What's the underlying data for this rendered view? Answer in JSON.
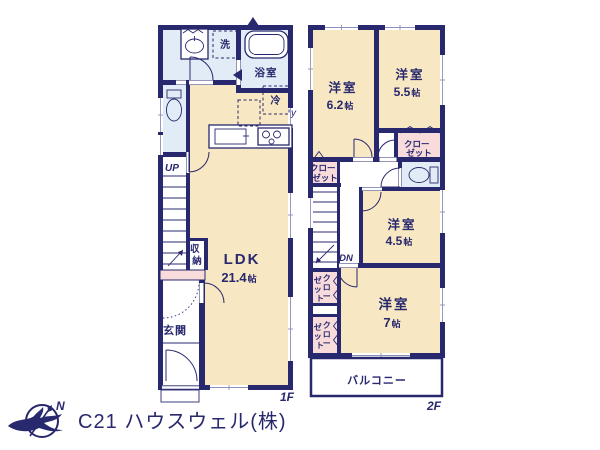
{
  "title": "間取り図",
  "colors": {
    "wall": "#28286e",
    "room": "#f7e7c3",
    "sanitary": "#e2ecf6",
    "closet": "#f8dcdc",
    "text": "#28286e",
    "logo_text": "#c8c8c8",
    "background": "#ffffff"
  },
  "floor1": {
    "floor_label": "1F",
    "ldk": {
      "name": "LDK",
      "size_num": "21.4",
      "size_unit": "帖"
    },
    "entrance_label": "玄関",
    "bath_label": "浴室",
    "laundry_label": "洗",
    "fridge_label": "冷",
    "storage_label": {
      "char1": "収",
      "char2": "納"
    },
    "stairs_label": "UP",
    "wall_annotation": "y"
  },
  "floor2": {
    "floor_label": "2F",
    "room_6_2": {
      "name": "洋室",
      "size_num": "6.2",
      "size_unit": "帖"
    },
    "room_5_5": {
      "name": "洋室",
      "size_num": "5.5",
      "size_unit": "帖"
    },
    "room_4_5": {
      "name": "洋室",
      "size_num": "4.5",
      "size_unit": "帖"
    },
    "room_7": {
      "name": "洋室",
      "size_num": "7",
      "size_unit": "帖"
    },
    "closet_left": {
      "line1": "クロー",
      "line2": "ゼット"
    },
    "closet_right": {
      "line1": "クロー",
      "line2": "ゼット"
    },
    "closet_a": {
      "col1": [
        "ク",
        "ロ",
        "ー"
      ],
      "col2": [
        "ゼ",
        "ッ",
        "ト"
      ]
    },
    "closet_b": {
      "col1": [
        "ク",
        "ロ",
        "ー"
      ],
      "col2": [
        "ゼ",
        "ッ",
        "ト"
      ]
    },
    "stairs_label": "DN",
    "balcony_label": "バルコニー"
  },
  "footer": {
    "company": "C21 ハウスウェル(株)",
    "compass_north": "N"
  }
}
